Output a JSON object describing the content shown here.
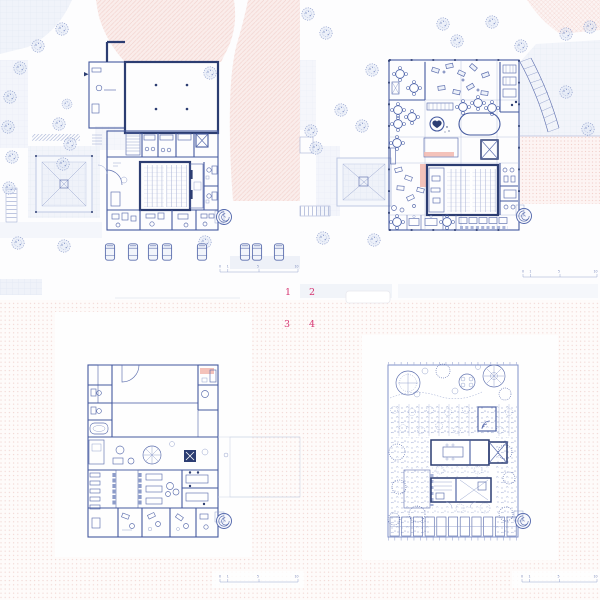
{
  "sheet": {
    "plans": [
      {
        "label": "1"
      },
      {
        "label": "2"
      },
      {
        "label": "3"
      },
      {
        "label": "4"
      }
    ],
    "scale_bar": {
      "ticks": [
        "0",
        "1",
        "5",
        "10"
      ]
    },
    "colors": {
      "wall_navy": "#2c3d72",
      "line_blue": "#5166ab",
      "accent_pink": "#f2b7ae",
      "terrain_pink": "#f6dbd7",
      "dot_background_pink": "#f1d6d2",
      "paving_blue": "#eff2f9",
      "label_pink": "#d63572",
      "tree_blue": "#8b9bca"
    }
  }
}
